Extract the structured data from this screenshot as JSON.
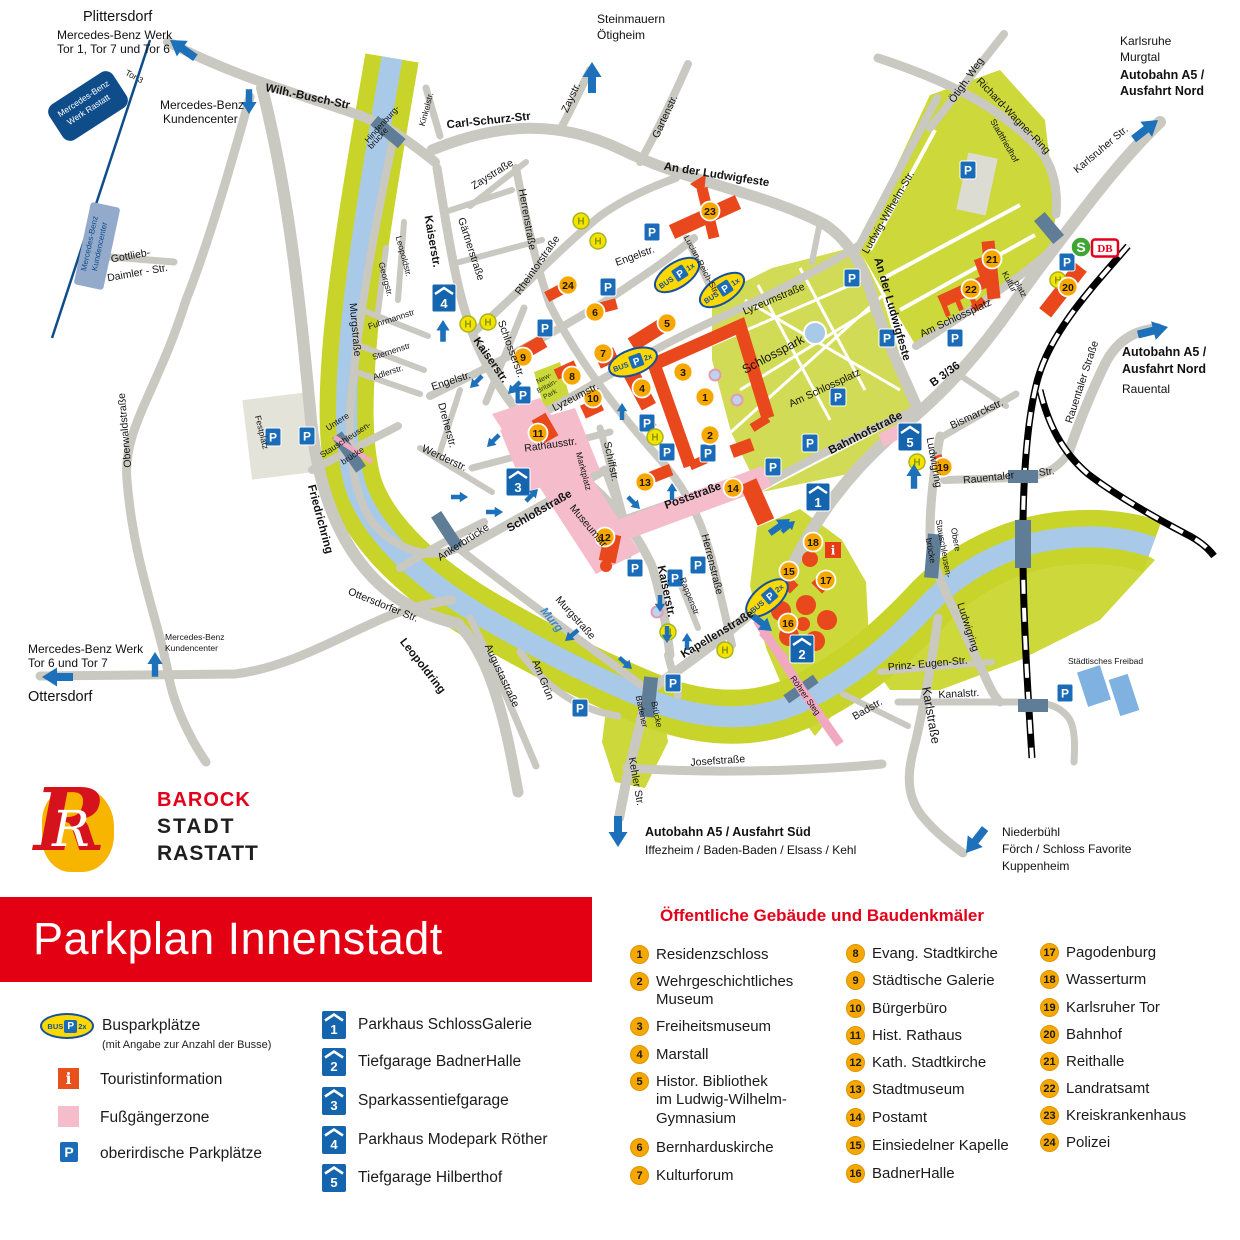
{
  "title": {
    "banner": "Parkplan Innenstadt"
  },
  "logo": {
    "monogram": "R",
    "line1": "BAROCK",
    "line2": "STADT",
    "line3": "RASTATT"
  },
  "icons": {
    "p": "P",
    "h": "H",
    "bus": "BUS",
    "bus_1x": "1x",
    "bus_2x": "2x",
    "s": "S",
    "db": "DB",
    "info": "i"
  },
  "legend": {
    "bus_label": "Busparkplätze",
    "bus_sub": "(mit Angabe zur Anzahl der Busse)",
    "info_label": "Touristinformation",
    "pedestrian_label": "Fußgängerzone",
    "parking_label": "oberirdische Parkplätze",
    "parkings": [
      {
        "num": "1",
        "label": "Parkhaus SchlossGalerie"
      },
      {
        "num": "2",
        "label": "Tiefgarage BadnerHalle"
      },
      {
        "num": "3",
        "label": "Sparkassentiefgarage"
      },
      {
        "num": "4",
        "label": "Parkhaus Modepark Röther"
      },
      {
        "num": "5",
        "label": "Tiefgarage Hilberthof"
      }
    ],
    "buildings_title": "Öffentliche Gebäude und Baudenkmäler",
    "buildings": [
      {
        "num": "1",
        "label": "Residenzschloss"
      },
      {
        "num": "2",
        "label": "Wehrgeschichtliches\nMuseum"
      },
      {
        "num": "3",
        "label": "Freiheitsmuseum"
      },
      {
        "num": "4",
        "label": "Marstall"
      },
      {
        "num": "5",
        "label": "Histor. Bibliothek\nim Ludwig-Wilhelm-\nGymnasium"
      },
      {
        "num": "6",
        "label": "Bernharduskirche"
      },
      {
        "num": "7",
        "label": "Kulturforum"
      },
      {
        "num": "8",
        "label": "Evang. Stadtkirche"
      },
      {
        "num": "9",
        "label": "Städtische Galerie"
      },
      {
        "num": "10",
        "label": "Bürgerbüro"
      },
      {
        "num": "11",
        "label": "Hist. Rathaus"
      },
      {
        "num": "12",
        "label": "Kath. Stadtkirche"
      },
      {
        "num": "13",
        "label": "Stadtmuseum"
      },
      {
        "num": "14",
        "label": "Postamt"
      },
      {
        "num": "15",
        "label": "Einsiedelner Kapelle"
      },
      {
        "num": "16",
        "label": "BadnerHalle"
      },
      {
        "num": "17",
        "label": "Pagodenburg"
      },
      {
        "num": "18",
        "label": "Wasserturm"
      },
      {
        "num": "19",
        "label": "Karlsruher Tor"
      },
      {
        "num": "20",
        "label": "Bahnhof"
      },
      {
        "num": "21",
        "label": "Reithalle"
      },
      {
        "num": "22",
        "label": "Landratsamt"
      },
      {
        "num": "23",
        "label": "Kreiskrankenhaus"
      },
      {
        "num": "24",
        "label": "Polizei"
      }
    ]
  },
  "map": {
    "labels": {
      "wilh_busch": "Wilh.-Busch-Str",
      "hindenburg1": "Hindenburg-",
      "hindenburg2": "brücke",
      "tor3": "Tor 3",
      "gottlieb1": "Gottlieb-",
      "gottlieb2": "Daimler - Str.",
      "oberwald": "Oberwaldstraße",
      "friedrichring": "Friedrichring",
      "leopoldring": "Leopoldring",
      "ottersdorfer": "Ottersdorfer Str.",
      "murgstr1": "Murgstraße",
      "murgstr2": "Murgstraße",
      "murg": "Murg",
      "fuhrmann": "Fuhrmannstr",
      "sternen": "Sternenstr",
      "adler": "Adlerstr.",
      "leopoldstr": "Leopoldstr.",
      "georgstr": "Georgstr.",
      "kinkel": "Kinkelstr.",
      "carl_schurz": "Carl-Schurz-Str",
      "zaystr": "Zaystr.",
      "zaystrasse": "Zaystraße",
      "gaertner": "Gärtnerstraße",
      "kaiser1": "Kaiserstr.",
      "kaiser2": "Kaiserstr.",
      "kaiser3": "Kaiserstr.",
      "herren1": "Herrenstraße",
      "herren2": "Herrenstraße",
      "rheintor": "Rheintorstraße",
      "garten": "Gartenstr.",
      "ludwigfeste1": "An der Ludwigfeste",
      "ludwigfeste2": "An der Ludwigfeste",
      "lucian": "Lucian-Reich-Str.",
      "engel1": "Engelstr.",
      "engel2": "Engelstr.",
      "lyzeum1": "Lyzeumstraße",
      "lyzeum2": "Lyzeumstr.",
      "schlosser": "Schlosserstr.",
      "dreher": "Dreherstr.",
      "werder": "Werderstr.",
      "rathaus": "Rathausstr.",
      "marktplatz": "Marktplatz",
      "schiff": "Schiffstr.",
      "museum": "Museumstr",
      "schloss_str": "Schloßstraße",
      "post": "Poststraße",
      "rappen": "Rappenstr",
      "kapellen": "Kapellenstraße",
      "am_gruen": "Am Grün",
      "augusta": "Augustastraße",
      "badener1": "Badener",
      "badener2": "Brücke",
      "kehler": "Kehler Str.",
      "josef": "Josefstraße",
      "festplatz": "Festplatz",
      "ustau1": "Untere",
      "ustau2": "Stauschleusen-",
      "ustau3": "brücke",
      "anker": "Ankerbrücke",
      "schlosspark": "Schlosspark",
      "stadtfriedhof": "Stadtfriedhof",
      "kultur1": "Kultur",
      "kultur2": "platz",
      "am_schlossplatz1": "Am Schlossplatz",
      "am_schlossplatz2": "Am Schlossplatz",
      "ludwig_wilhelm": "Ludwig-Wilhelm-Str.",
      "oetigh_weg": "Ötigh. Weg",
      "richard_wagner": "Richard-Wagner-Ring",
      "karlsruher": "Karlsruher Str.",
      "bahnhofstr": "Bahnhofstraße",
      "b336": "B 3/36",
      "bismarck": "Bismarckstr.",
      "rauentaler1": "Rauentaler",
      "rauentaler1b": "Str.",
      "rauentaler2": "Rauentaler Straße",
      "ludwigring1": "Ludwigring",
      "ludwigring2": "Ludwigring",
      "ostau1": "Obere",
      "ostau2": "Stauschleusen-",
      "ostau3": "brücke",
      "roehrer": "Röhrer Steg",
      "prinz_eugen": "Prinz- Eugen-Str.",
      "kanal": "Kanalstr.",
      "badstr": "Badstr.",
      "karlstrasse": "Karlstraße",
      "freibad": "Städtisches Freibad",
      "nbp1": "New-",
      "nbp2": "Britain-",
      "nbp3": "Park",
      "mb_box1": "Mercedes-Benz",
      "mb_box2": "Werk Rastatt",
      "kc_box1": "Mercedes-Benz",
      "kc_box2": "Kundencenter"
    },
    "dest": {
      "plittersdorf": "Plittersdorf",
      "mb_tor1a": "Mercedes-Benz Werk",
      "mb_tor1b": "Tor 1, Tor 7 und Tor 6",
      "kundencenter1a": "Mercedes-Benz",
      "kundencenter1b": "Kundencenter",
      "steinmauern": "Steinmauern",
      "oetigheim": "Ötigheim",
      "karlsruhe1": "Karlsruhe",
      "karlsruhe2": "Murgtal",
      "karlsruhe3": "Autobahn A5 /",
      "karlsruhe4": "Ausfahrt Nord",
      "a5nord1": "Autobahn A5 /",
      "a5nord2": "Ausfahrt Nord",
      "a5nord3": "Rauental",
      "a5sued1": "Autobahn A5 / Ausfahrt Süd",
      "a5sued2": "Iffezheim / Baden-Baden / Elsass / Kehl",
      "niederbuehl1": "Niederbühl",
      "niederbuehl2": "Förch / Schloss Favorite",
      "niederbuehl3": "Kuppenheim",
      "ottersdorf": "Ottersdorf",
      "mb_tor2a": "Mercedes-Benz Werk",
      "mb_tor2b": "Tor 6 und Tor 7",
      "kundencenter2a": "Mercedes-Benz",
      "kundencenter2b": "Kundencenter"
    }
  }
}
